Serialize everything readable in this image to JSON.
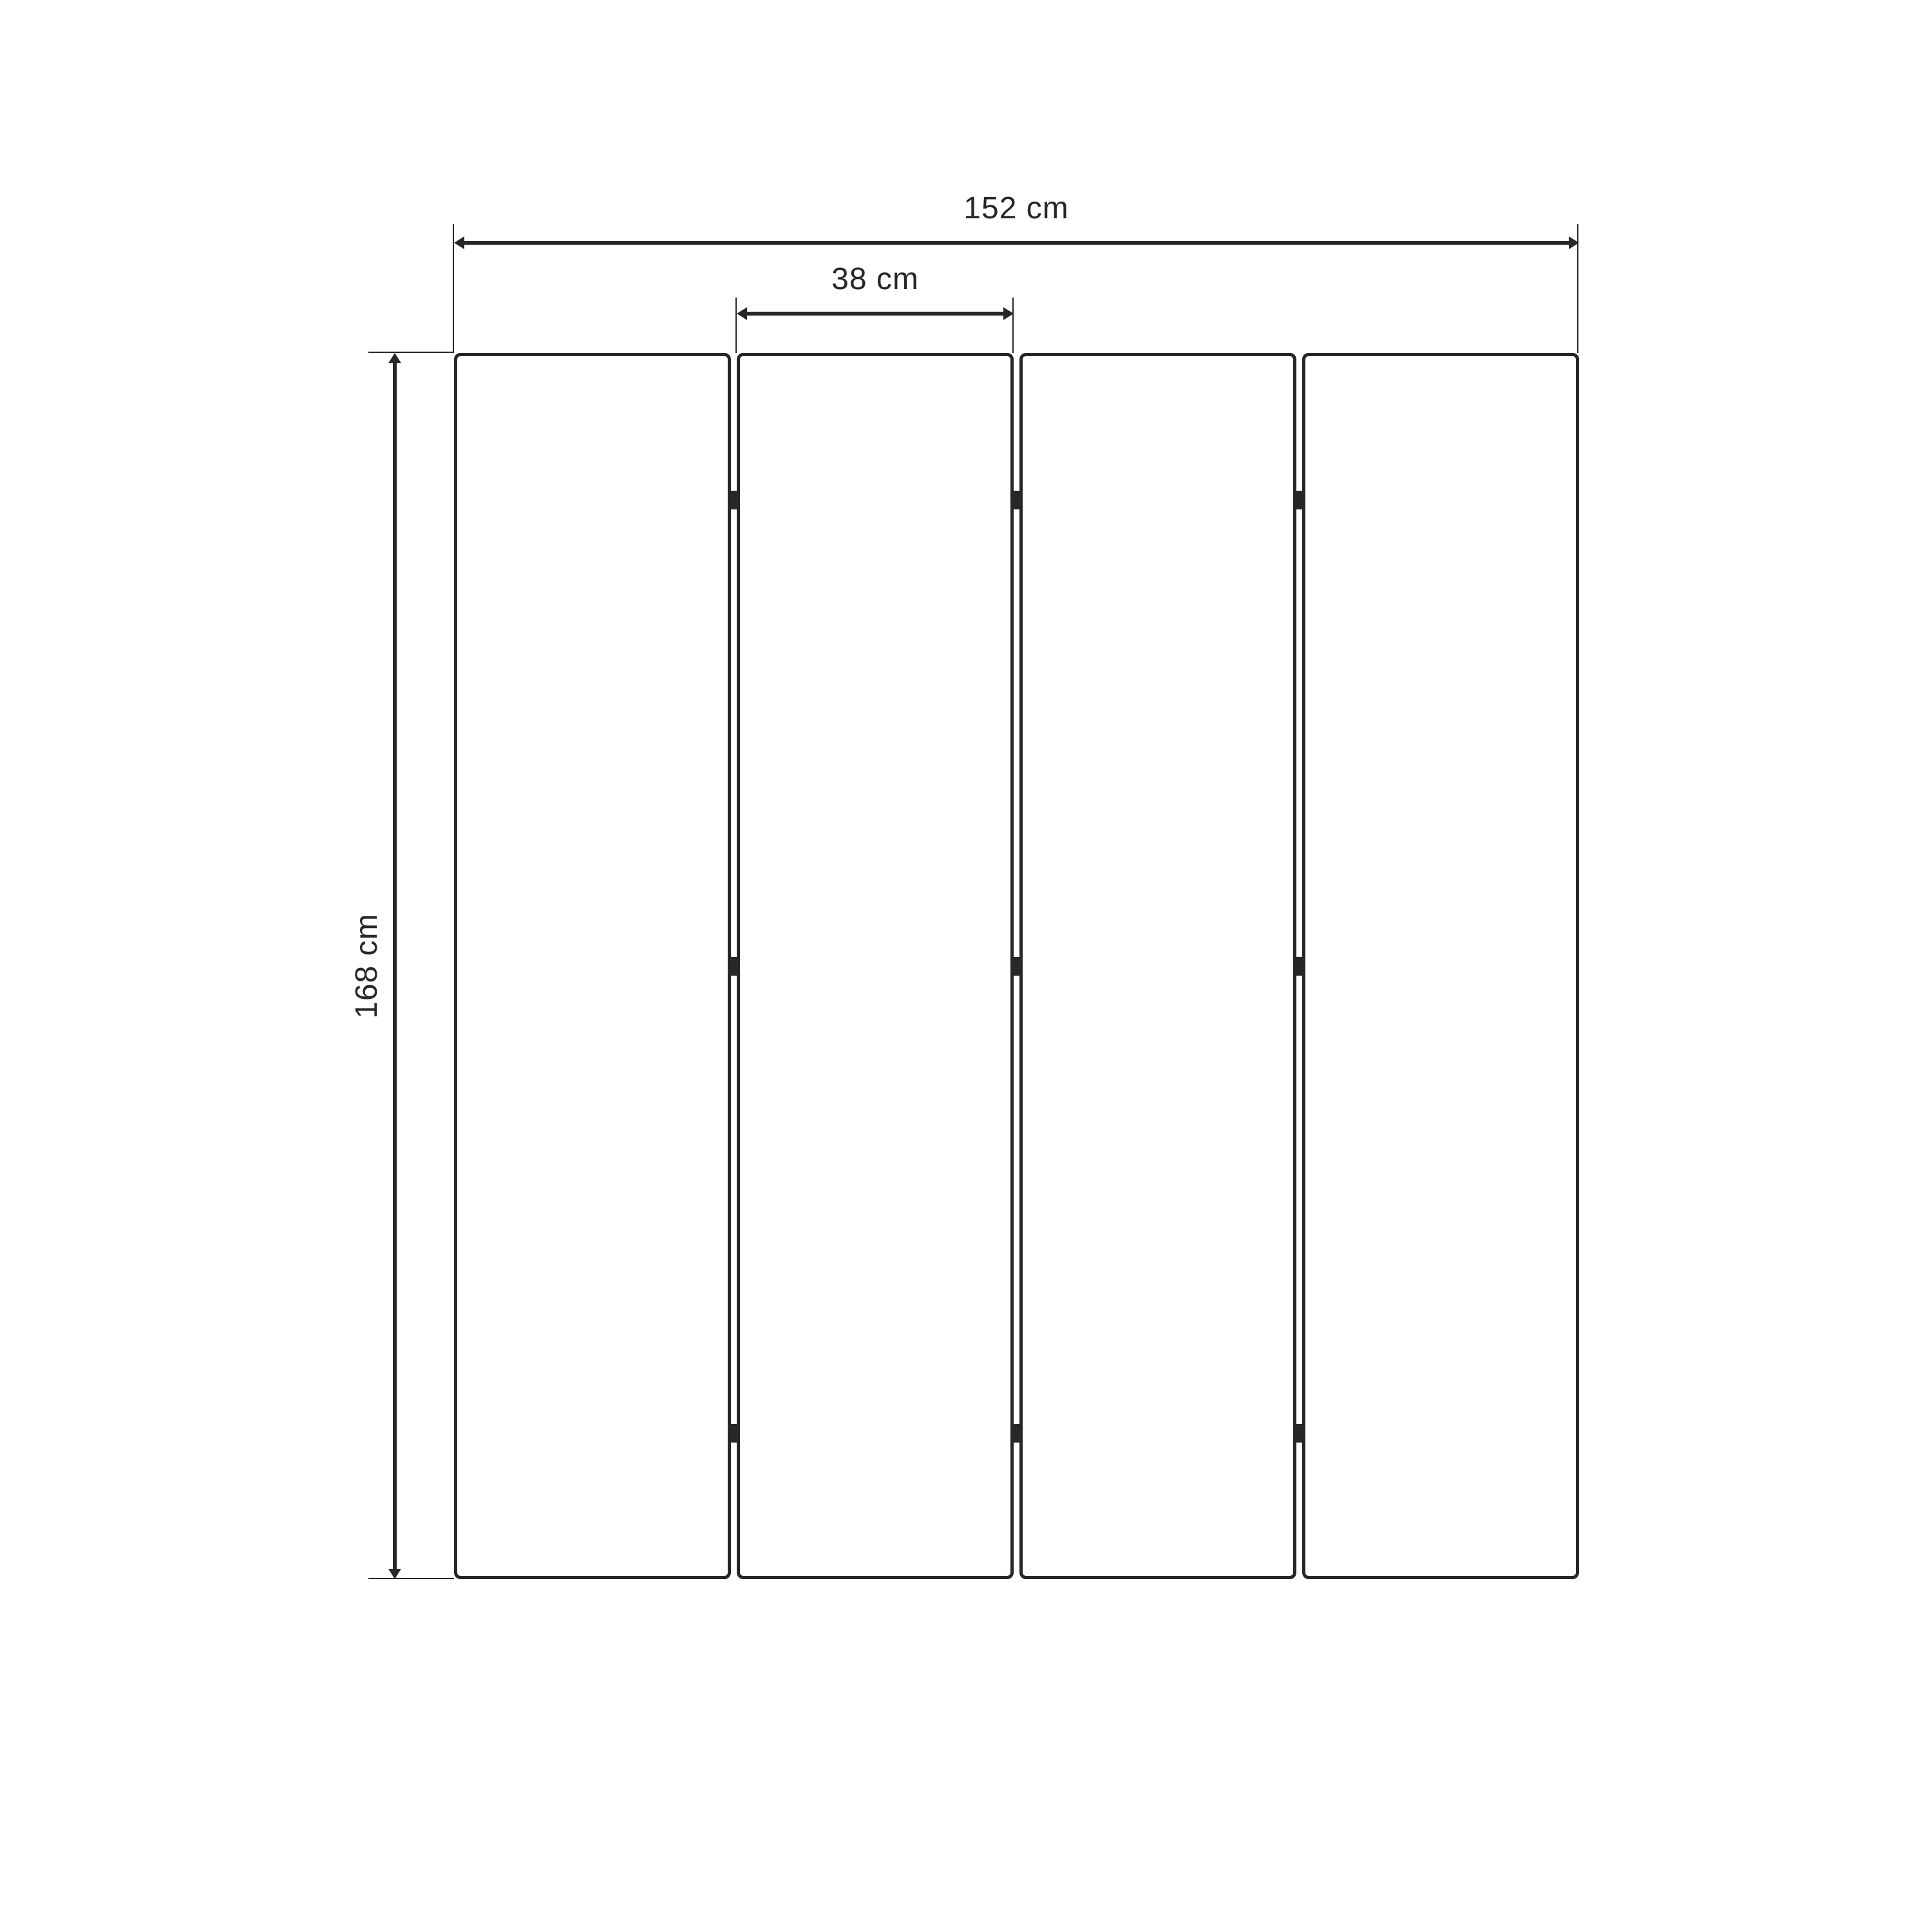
{
  "diagram": {
    "type": "furniture-dimension-diagram",
    "subject": "four-panel folding screen, front view",
    "panel_count": 4,
    "hinges_per_joint": 3,
    "dimensions": {
      "total_width": {
        "label": "152 cm",
        "value": 152,
        "unit": "cm"
      },
      "panel_width": {
        "label": "38 cm",
        "value": 38,
        "unit": "cm"
      },
      "height": {
        "label": "168 cm",
        "value": 168,
        "unit": "cm"
      }
    },
    "colors": {
      "stroke": "#272727",
      "background": "#ffffff"
    }
  }
}
